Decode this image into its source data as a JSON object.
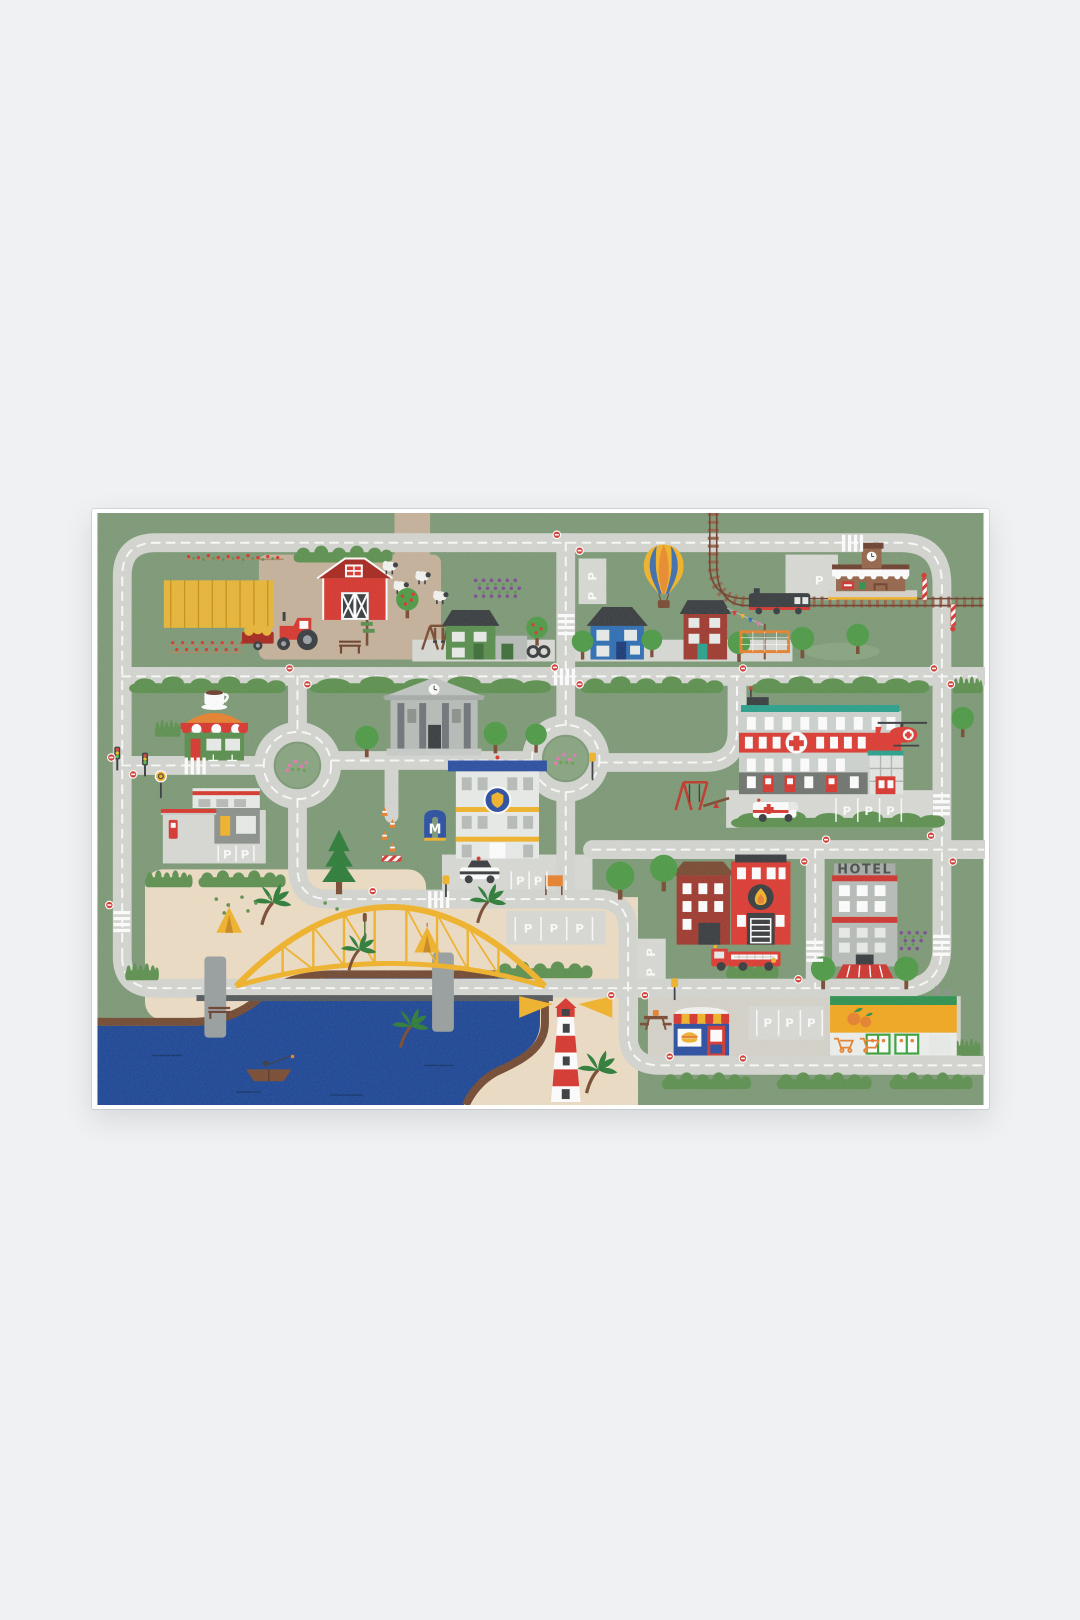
{
  "scene": {
    "description": "Illustrated children's city road play mat photographed on a plain light grey background",
    "background_color": "#f0f1f2"
  },
  "labels": {
    "hotel_sign": "HOTEL",
    "parking_space": "P",
    "metro_sign": "M"
  },
  "colors": {
    "page_bg": "#f0f1f2",
    "grass": "#7e9a77",
    "grass_light": "#89a581",
    "road": "#d5d6d1",
    "road_line": "#ffffff",
    "dirt": "#c6b29c",
    "sand": "#eeddc5",
    "paving": "#d6d3ca",
    "lot": "#d9dad5",
    "water": "#1e4796",
    "bank": "#744a33",
    "hedge": "#5e9150",
    "tree": "#4f9b47",
    "tree_dark": "#2e7d39",
    "trunk": "#7a4b33",
    "red": "#d8372f",
    "dark_red": "#a8281f",
    "maroon": "#a03a30",
    "yellow": "#f2b32a",
    "orange": "#e8822f",
    "wheat": "#e9b738",
    "teal": "#2aa18c",
    "blue": "#2b4fa2",
    "house_blue": "#2f6fb4",
    "house_green": "#5a8f4e",
    "gray_bld": "#b9bdb9",
    "gray_dark": "#6a6f6a",
    "charcoal": "#3a3d40",
    "white": "#ffffff",
    "window": "#e9ece9",
    "rail_brown": "#96664b",
    "balloon_blue": "#3e6fae",
    "hotel_text": "#4b4f4b",
    "market_yellow": "#f3a81f",
    "market_green": "#2f9150"
  },
  "landmarks": [
    "farm-barn",
    "wheat-field",
    "tractor-with-hay-trailer",
    "sheep",
    "apple-trees",
    "vegetable-gardens",
    "family-houses",
    "swing-sets",
    "hot-air-balloon",
    "railway-with-train",
    "train-station",
    "railroad-crossing",
    "town-hall",
    "cafe",
    "gas-station",
    "two-roundabouts",
    "police-station",
    "police-car",
    "metro-entrance",
    "roadworks-cones",
    "hospital",
    "medical-helicopter",
    "ambulance",
    "playground",
    "fire-station",
    "fire-truck",
    "hotel",
    "harbor-bridge",
    "river",
    "fishing-boat",
    "lighthouse",
    "beach-with-tents",
    "palm-trees",
    "burger-kiosk",
    "supermarket",
    "parking-areas",
    "stop-signs",
    "crosswalks"
  ]
}
